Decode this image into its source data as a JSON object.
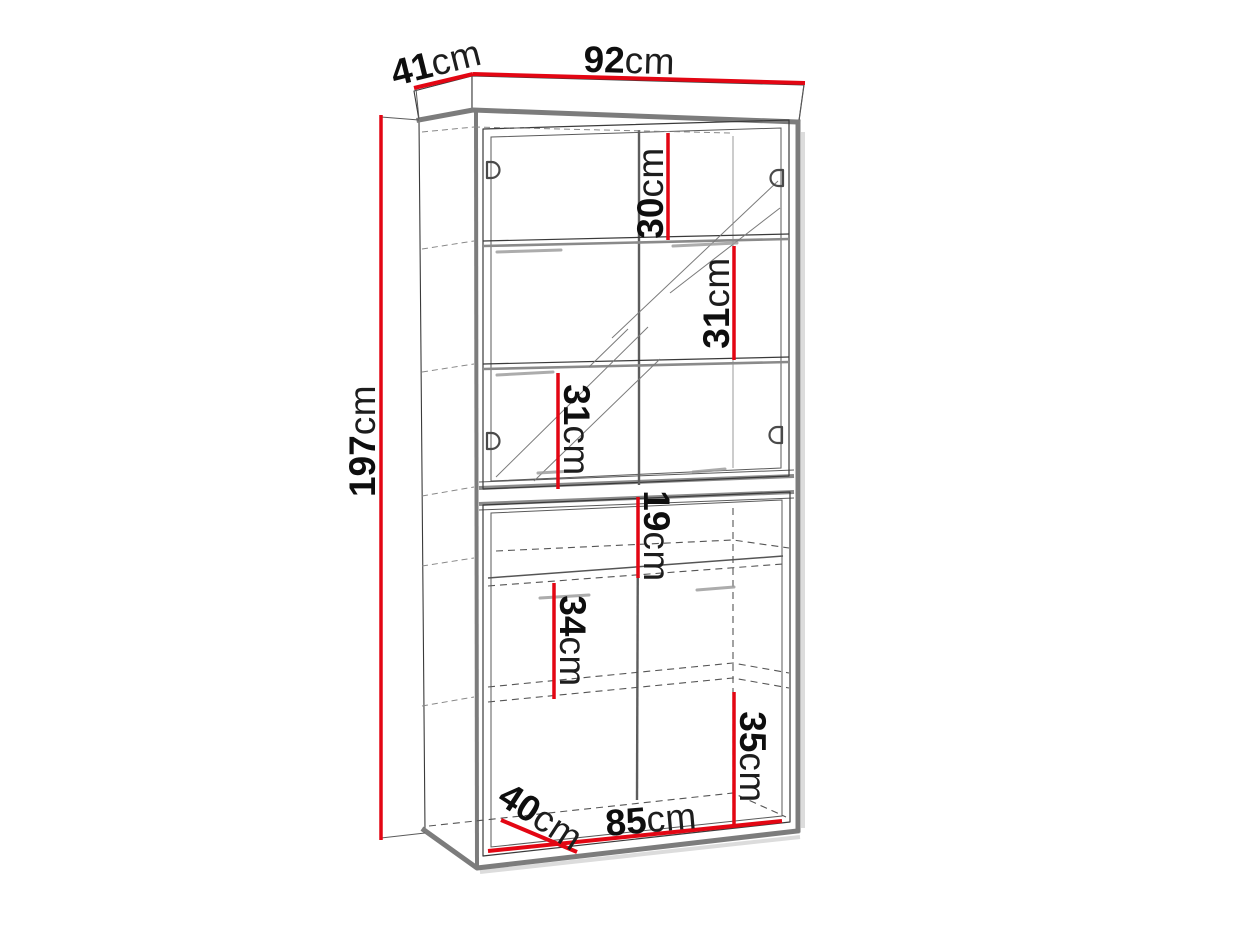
{
  "diagram": {
    "accent_color": "#e30613",
    "labels": {
      "top_depth": {
        "value": "41",
        "unit": "cm"
      },
      "top_width": {
        "value": "92",
        "unit": "cm"
      },
      "total_height": {
        "value": "197",
        "unit": "cm"
      },
      "upper_gap_top": {
        "value": "30",
        "unit": "cm"
      },
      "upper_gap_middle": {
        "value": "31",
        "unit": "cm"
      },
      "upper_gap_bottom": {
        "value": "31",
        "unit": "cm"
      },
      "lower_niche_height": {
        "value": "19",
        "unit": "cm"
      },
      "lower_gap_middle": {
        "value": "34",
        "unit": "cm"
      },
      "lower_gap_bottom": {
        "value": "35",
        "unit": "cm"
      },
      "inner_bottom_width": {
        "value": "85",
        "unit": "cm"
      },
      "bottom_depth": {
        "value": "40",
        "unit": "cm"
      }
    }
  }
}
